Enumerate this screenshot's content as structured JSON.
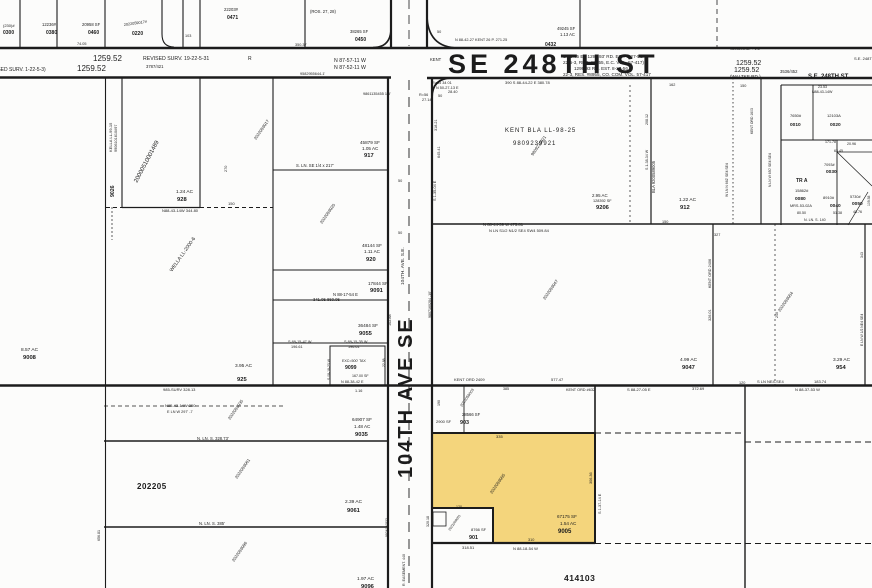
{
  "map": {
    "background": "#fcfcfb",
    "line_color": "#1c1c1c",
    "highlight_color": "#f4d57c",
    "streets": {
      "se_248th_main": "SE 248TH ST",
      "se_248th_right": "S.E. 248TH ST.",
      "waltke": "(WALTKE RD.)",
      "ave_104_main": "104TH AVE SE",
      "ave_104_small": "104TH. AVE. S.E."
    },
    "section_labels": [
      "202205",
      "414103"
    ],
    "highlighted_parcel": {
      "number": "9005",
      "sf": "67175 SF",
      "acres": "1.54 AC"
    }
  },
  "labels": [
    {
      "x": 3,
      "y": 27,
      "t": "(230)#",
      "s": 4
    },
    {
      "x": 3,
      "y": 34,
      "t": "0300",
      "s": 5,
      "b": 1
    },
    {
      "x": 42,
      "y": 26,
      "t": "12236#",
      "s": 4.2
    },
    {
      "x": 46,
      "y": 34,
      "t": "0380",
      "s": 5,
      "b": 1
    },
    {
      "x": 82,
      "y": 26,
      "t": "20958 SF",
      "s": 4.2
    },
    {
      "x": 88,
      "y": 34,
      "t": "0460",
      "s": 5,
      "b": 1
    },
    {
      "x": 77,
      "y": 45,
      "t": "74.05",
      "s": 3.8
    },
    {
      "x": 124,
      "y": 26,
      "t": "2022059017#",
      "s": 3.8,
      "r": -8
    },
    {
      "x": 132,
      "y": 35,
      "t": "0220",
      "s": 5,
      "b": 1
    },
    {
      "x": 185,
      "y": 37,
      "t": "103",
      "s": 3.8
    },
    {
      "x": 224,
      "y": 11,
      "t": "22203#",
      "s": 4.2
    },
    {
      "x": 227,
      "y": 19,
      "t": "0471",
      "s": 5,
      "b": 1
    },
    {
      "x": 310,
      "y": 13,
      "t": "(ROS. 27, 28)",
      "s": 4.2
    },
    {
      "x": 350,
      "y": 33,
      "t": "38265 SF",
      "s": 4.2
    },
    {
      "x": 355,
      "y": 41,
      "t": "0450",
      "s": 5,
      "b": 1
    },
    {
      "x": 295,
      "y": 46,
      "t": "350.37",
      "s": 3.8
    },
    {
      "x": 437,
      "y": 33,
      "t": "50",
      "s": 3.8
    },
    {
      "x": 455,
      "y": 41,
      "t": "N 88-42-27 KENT 26 P.  271.25",
      "s": 3.8
    },
    {
      "x": 557,
      "y": 30,
      "t": "49245 SF",
      "s": 4.2
    },
    {
      "x": 560,
      "y": 36,
      "t": "1.13 AC",
      "s": 4.2
    },
    {
      "x": 545,
      "y": 46,
      "t": "0432",
      "s": 5,
      "b": 1
    },
    {
      "x": 730,
      "y": 50,
      "t": "9803293487 - 1.5'",
      "s": 3.8
    },
    {
      "x": 93,
      "y": 61,
      "t": "1259.52",
      "s": 8
    },
    {
      "x": 143,
      "y": 60,
      "t": "REVISED SURV. 19-22-5-31",
      "s": 5.2
    },
    {
      "x": 248,
      "y": 60,
      "t": "R",
      "s": 5
    },
    {
      "x": 77,
      "y": 71,
      "t": "1259.52",
      "s": 8
    },
    {
      "x": -16,
      "y": 71,
      "t": "(REVISED SURV. 1-22-5-3)",
      "s": 5
    },
    {
      "x": 146,
      "y": 68,
      "t": "3787/421",
      "s": 4.2
    },
    {
      "x": 334,
      "y": 62,
      "t": "N 87-57-11 W",
      "s": 5.2
    },
    {
      "x": 334,
      "y": 69,
      "t": "N 87-52-11 W",
      "s": 5.2
    },
    {
      "x": 300,
      "y": 75,
      "t": "9582955644-1'",
      "s": 3.8
    },
    {
      "x": 430,
      "y": 61,
      "t": "KENT",
      "s": 4.2
    },
    {
      "x": 563,
      "y": 58,
      "t": "S 88-45 E - 1299.93' RD. EST. 8-27-56.",
      "s": 4.6
    },
    {
      "x": 563,
      "y": 64,
      "t": "22-5-3, RES. #8955, E.C. VOL. 57-417)",
      "s": 4.6
    },
    {
      "x": 736,
      "y": 65,
      "t": "1259.52",
      "s": 7
    },
    {
      "x": 574,
      "y": 70,
      "t": "1299.93 RD. EST. 8-27-56",
      "s": 4.6
    },
    {
      "x": 734,
      "y": 72,
      "t": "1259.52",
      "s": 7
    },
    {
      "x": 563,
      "y": 76,
      "t": "22-3, RES. #8955, CO. COM. VOL. 57-417",
      "s": 4.6
    },
    {
      "x": 780,
      "y": 73,
      "t": "3536/452",
      "s": 4.2
    },
    {
      "x": 854,
      "y": 60,
      "t": "S.E. 248TH ST.",
      "s": 4
    },
    {
      "x": 432,
      "y": 84,
      "t": "R=55 34 01",
      "s": 3.8
    },
    {
      "x": 436,
      "y": 89,
      "t": "N 50-27-13 E",
      "s": 3.8
    },
    {
      "x": 448,
      "y": 93,
      "t": "28.40",
      "s": 3.8
    },
    {
      "x": 419,
      "y": 96,
      "t": "R=56",
      "s": 3.8
    },
    {
      "x": 422,
      "y": 101,
      "t": "27.14",
      "s": 3.8
    },
    {
      "x": 363,
      "y": 95,
      "t": "9861135455 1.5'",
      "s": 3.8
    },
    {
      "x": 505,
      "y": 84,
      "t": "390    S 88-44-22 E    380.78",
      "s": 4
    },
    {
      "x": 112,
      "y": 152,
      "t": "KELLA LL-99-15",
      "s": 4,
      "r": -90
    },
    {
      "x": 117,
      "y": 152,
      "t": "9906101610#97",
      "s": 3.8,
      "r": -90
    },
    {
      "x": 114,
      "y": 197,
      "t": "9026",
      "s": 5.2,
      "b": 1,
      "r": -90
    },
    {
      "x": 176,
      "y": 193,
      "t": "1.24 AC",
      "s": 4.8
    },
    {
      "x": 177,
      "y": 201,
      "t": "928",
      "s": 5.8,
      "b": 1
    },
    {
      "x": 227,
      "y": 172,
      "t": "270",
      "s": 3.8,
      "r": -90
    },
    {
      "x": 137,
      "y": 183,
      "t": "20000510001489",
      "s": 6,
      "r": -62,
      "c": "#a8a8a8"
    },
    {
      "x": 256,
      "y": 140,
      "t": "2022059017",
      "s": 4.2,
      "r": -55,
      "c": "#b5b5b5"
    },
    {
      "x": 360,
      "y": 144,
      "t": "45879 SF",
      "s": 4.6
    },
    {
      "x": 362,
      "y": 150,
      "t": "1.05 AC",
      "s": 4.6
    },
    {
      "x": 364,
      "y": 157,
      "t": "917",
      "s": 5.8,
      "b": 1
    },
    {
      "x": 296,
      "y": 167,
      "t": "S. LN. SE 1/4 x 217'",
      "s": 4.2
    },
    {
      "x": 322,
      "y": 224,
      "t": "2022059020",
      "s": 4.2,
      "r": -55,
      "c": "#b5b5b5"
    },
    {
      "x": 362,
      "y": 247,
      "t": "48144 SF",
      "s": 4.6
    },
    {
      "x": 364,
      "y": 253,
      "t": "1.11 AC",
      "s": 4.6
    },
    {
      "x": 366,
      "y": 261,
      "t": "920",
      "s": 5.8,
      "b": 1
    },
    {
      "x": 368,
      "y": 285,
      "t": "17844 SF",
      "s": 4.6
    },
    {
      "x": 370,
      "y": 292,
      "t": "9091",
      "s": 5.8,
      "b": 1
    },
    {
      "x": 333,
      "y": 296,
      "t": "N 88-17-54 E",
      "s": 4.2
    },
    {
      "x": 313,
      "y": 301,
      "t": "341.05   860.05",
      "s": 4.2
    },
    {
      "x": 358,
      "y": 327,
      "t": "36484 SF",
      "s": 4.6
    },
    {
      "x": 391,
      "y": 326,
      "t": "102.88",
      "s": 3.8,
      "r": -90
    },
    {
      "x": 359,
      "y": 335,
      "t": "9055",
      "s": 5.8,
      "b": 1
    },
    {
      "x": 288,
      "y": 343,
      "t": "S 89-15-47 W",
      "s": 3.8
    },
    {
      "x": 291,
      "y": 348,
      "t": "196.61",
      "s": 3.8
    },
    {
      "x": 344,
      "y": 343,
      "t": "S 89-15-35 W",
      "s": 3.8
    },
    {
      "x": 348,
      "y": 348,
      "t": "196.61",
      "s": 3.8
    },
    {
      "x": 342,
      "y": 362,
      "t": "EXC=500' TAX",
      "s": 3.6
    },
    {
      "x": 345,
      "y": 369,
      "t": "9099",
      "s": 5.2,
      "b": 1
    },
    {
      "x": 352,
      "y": 377,
      "t": "167.00 SF",
      "s": 3.6
    },
    {
      "x": 341,
      "y": 383,
      "t": "N 88-38-42 E",
      "s": 3.8
    },
    {
      "x": 355,
      "y": 392,
      "t": "1.16",
      "s": 3.8
    },
    {
      "x": 330,
      "y": 380,
      "t": "S 08-18-23 W",
      "s": 3.4,
      "r": -90
    },
    {
      "x": 385,
      "y": 367,
      "t": "22.88",
      "s": 3.4,
      "r": -90
    },
    {
      "x": 235,
      "y": 367,
      "t": "3.95 AC",
      "s": 4.8
    },
    {
      "x": 237,
      "y": 381,
      "t": "925",
      "s": 5.8,
      "b": 1
    },
    {
      "x": 172,
      "y": 272,
      "t": "WELLA LL-2000-6",
      "s": 5,
      "r": -55
    },
    {
      "x": 162,
      "y": 212,
      "t": "N88-43-14W   344.80",
      "s": 4
    },
    {
      "x": 228,
      "y": 205,
      "t": "150",
      "s": 4
    },
    {
      "x": 21,
      "y": 351,
      "t": "8.57 AC",
      "s": 4.8
    },
    {
      "x": 23,
      "y": 359,
      "t": "9008",
      "s": 5.8,
      "b": 1
    },
    {
      "x": 163,
      "y": 391,
      "t": "985-SURV   328.13",
      "s": 4
    },
    {
      "x": 165,
      "y": 407,
      "t": "N85-43-14W    350",
      "s": 4
    },
    {
      "x": 167,
      "y": 413,
      "t": "E LN W 297' -7",
      "s": 3.8
    },
    {
      "x": 230,
      "y": 420,
      "t": "2022059035",
      "s": 4.2,
      "r": -55,
      "c": "#b5b5b5"
    },
    {
      "x": 352,
      "y": 421,
      "t": "64907 SF",
      "s": 4.6
    },
    {
      "x": 354,
      "y": 428,
      "t": "1.48 AC",
      "s": 4.6
    },
    {
      "x": 355,
      "y": 436,
      "t": "9035",
      "s": 5.8,
      "b": 1
    },
    {
      "x": 197,
      "y": 440,
      "t": "N. LN. S. 328.73'",
      "s": 4.2
    },
    {
      "x": 237,
      "y": 479,
      "t": "2022059061",
      "s": 4.2,
      "r": -55,
      "c": "#b5b5b5"
    },
    {
      "x": 345,
      "y": 503,
      "t": "2.39 AC",
      "s": 4.8
    },
    {
      "x": 347,
      "y": 512,
      "t": "9061",
      "s": 5.8,
      "b": 1
    },
    {
      "x": 199,
      "y": 525,
      "t": "N. LN. S. 385'",
      "s": 4.2
    },
    {
      "x": 234,
      "y": 562,
      "t": "2022059096",
      "s": 4.2,
      "r": -55,
      "c": "#b5b5b5"
    },
    {
      "x": 357,
      "y": 580,
      "t": "1.97 AC",
      "s": 4.8
    },
    {
      "x": 361,
      "y": 588,
      "t": "9096",
      "s": 5.8,
      "b": 1
    },
    {
      "x": 100,
      "y": 541,
      "t": "656.81",
      "s": 3.6,
      "r": -90
    },
    {
      "x": 388,
      "y": 537,
      "t": "9924190532",
      "s": 3.4,
      "r": -90,
      "c": "#9a9a9a"
    },
    {
      "x": 398,
      "y": 182,
      "t": "50",
      "s": 3.8
    },
    {
      "x": 398,
      "y": 234,
      "t": "50",
      "s": 3.8
    },
    {
      "x": 438,
      "y": 97,
      "t": "50",
      "s": 3.8
    },
    {
      "x": 431,
      "y": 318,
      "t": "9807160284 -10'",
      "s": 3.6,
      "r": -90
    },
    {
      "x": 429,
      "y": 527,
      "t": "320.18",
      "s": 3.6,
      "r": -90
    },
    {
      "x": 405,
      "y": 586,
      "t": "R. EASEMENT. 440",
      "s": 3.6,
      "r": -90,
      "c": "#8a8a8a"
    },
    {
      "x": 505,
      "y": 132,
      "t": "KENT BLA LL-98-25",
      "s": 6,
      "ls": 1
    },
    {
      "x": 513,
      "y": 145,
      "t": "9809239921",
      "s": 6,
      "ls": 1
    },
    {
      "x": 533,
      "y": 156,
      "t": "9809239921",
      "s": 4.2,
      "r": -55,
      "c": "#b5b5b5"
    },
    {
      "x": 592,
      "y": 197,
      "t": "2.95 AC",
      "s": 4.4
    },
    {
      "x": 593,
      "y": 202,
      "t": "128392 SF",
      "s": 3.8
    },
    {
      "x": 596,
      "y": 209,
      "t": "9206",
      "s": 5.8,
      "b": 1
    },
    {
      "x": 440,
      "y": 158,
      "t": "645.41",
      "s": 3.8,
      "r": -90
    },
    {
      "x": 437,
      "y": 131,
      "t": "318.21",
      "s": 3.8,
      "r": -90
    },
    {
      "x": 436,
      "y": 201,
      "t": "S 1-35-04 E",
      "s": 3.8,
      "r": -90
    },
    {
      "x": 648,
      "y": 170,
      "t": "S 1-38-34 W",
      "s": 3.6,
      "r": -90
    },
    {
      "x": 648,
      "y": 125,
      "t": "208.12",
      "s": 3.6,
      "r": -90
    },
    {
      "x": 483,
      "y": 226,
      "t": "N 88-44-39 W    475.81",
      "s": 4.2
    },
    {
      "x": 489,
      "y": 232,
      "t": "N LN S1/2 N1/2 SE4 SW4    509.84",
      "s": 4
    },
    {
      "x": 662,
      "y": 223,
      "t": "150",
      "s": 3.8
    },
    {
      "x": 714,
      "y": 236,
      "t": "327",
      "s": 3.8
    },
    {
      "x": 679,
      "y": 201,
      "t": "1.22 AC",
      "s": 4.8
    },
    {
      "x": 680,
      "y": 209,
      "t": "912",
      "s": 5.8,
      "b": 1
    },
    {
      "x": 655,
      "y": 193,
      "t": "BLA 9200589005",
      "s": 4.2,
      "r": -90
    },
    {
      "x": 669,
      "y": 86,
      "t": "162",
      "s": 3.8
    },
    {
      "x": 740,
      "y": 87,
      "t": "150",
      "s": 3.8
    },
    {
      "x": 728,
      "y": 197,
      "t": "W LN N 662' SE4 SE4",
      "s": 3.4,
      "r": -90
    },
    {
      "x": 753,
      "y": 134,
      "t": "KENT ORD 1603",
      "s": 3.4,
      "r": -90
    },
    {
      "x": 771,
      "y": 187,
      "t": "N LN W 650' SE4 SE4",
      "s": 3.4,
      "r": -90
    },
    {
      "x": 818,
      "y": 88,
      "t": "23.53",
      "s": 3.6
    },
    {
      "x": 812,
      "y": 93,
      "t": "N88-43-14W",
      "s": 3.6
    },
    {
      "x": 790,
      "y": 117,
      "t": "7650#",
      "s": 4
    },
    {
      "x": 790,
      "y": 126,
      "t": "0010",
      "s": 4.8,
      "b": 1
    },
    {
      "x": 827,
      "y": 117,
      "t": "12103A",
      "s": 4
    },
    {
      "x": 830,
      "y": 126,
      "t": "0020",
      "s": 4.8,
      "b": 1
    },
    {
      "x": 825,
      "y": 143,
      "t": "171.78",
      "s": 3.6
    },
    {
      "x": 847,
      "y": 145,
      "t": "20.96",
      "s": 3.6
    },
    {
      "x": 834,
      "y": 152,
      "t": "63.45",
      "s": 3.6
    },
    {
      "x": 796,
      "y": 182,
      "t": "TR A",
      "s": 5,
      "b": 1
    },
    {
      "x": 795,
      "y": 192,
      "t": "15862#",
      "s": 4
    },
    {
      "x": 795,
      "y": 200,
      "t": "0080",
      "s": 4.8,
      "b": 1
    },
    {
      "x": 790,
      "y": 207,
      "t": "MRS-53-02A",
      "s": 3.8
    },
    {
      "x": 797,
      "y": 214,
      "t": "80.50",
      "s": 3.6
    },
    {
      "x": 804,
      "y": 221,
      "t": "N. LN. S. 140",
      "s": 3.6
    },
    {
      "x": 824,
      "y": 166,
      "t": "7093#",
      "s": 3.8
    },
    {
      "x": 826,
      "y": 173,
      "t": "0030",
      "s": 4.8,
      "b": 1
    },
    {
      "x": 823,
      "y": 199,
      "t": "8910#",
      "s": 4
    },
    {
      "x": 830,
      "y": 207,
      "t": "0040",
      "s": 4.8,
      "b": 1
    },
    {
      "x": 833,
      "y": 214,
      "t": "51.38",
      "s": 3.6
    },
    {
      "x": 850,
      "y": 198,
      "t": "5730#",
      "s": 3.8
    },
    {
      "x": 852,
      "y": 205,
      "t": "0050",
      "s": 4.8,
      "b": 1
    },
    {
      "x": 853,
      "y": 213,
      "t": "48.76",
      "s": 3.6
    },
    {
      "x": 870,
      "y": 206,
      "t": "109.58",
      "s": 3.4,
      "r": -90
    },
    {
      "x": 545,
      "y": 300,
      "t": "2022059047",
      "s": 4.2,
      "r": -55,
      "c": "#b5b5b5"
    },
    {
      "x": 680,
      "y": 361,
      "t": "4.99 AC",
      "s": 4.8
    },
    {
      "x": 682,
      "y": 369,
      "t": "9047",
      "s": 5.8,
      "b": 1
    },
    {
      "x": 711,
      "y": 288,
      "t": "KENT ORD 2406",
      "s": 3.8,
      "r": -90
    },
    {
      "x": 711,
      "y": 321,
      "t": "326.01",
      "s": 3.8,
      "r": -90
    },
    {
      "x": 780,
      "y": 312,
      "t": "2022059054",
      "s": 4.2,
      "r": -55,
      "c": "#b5b5b5"
    },
    {
      "x": 833,
      "y": 361,
      "t": "3.29 AC",
      "s": 4.8
    },
    {
      "x": 836,
      "y": 369,
      "t": "954",
      "s": 5.8,
      "b": 1
    },
    {
      "x": 863,
      "y": 346,
      "t": "E LN W 1/2 NE4 SE4",
      "s": 3.4,
      "r": -90
    },
    {
      "x": 863,
      "y": 258,
      "t": "343",
      "s": 3.6,
      "r": -90
    },
    {
      "x": 778,
      "y": 318,
      "t": "240",
      "s": 3.6,
      "r": -90
    },
    {
      "x": 627,
      "y": 391,
      "t": "S 88-27-05 E",
      "s": 4
    },
    {
      "x": 692,
      "y": 390,
      "t": "372.69",
      "s": 4
    },
    {
      "x": 739,
      "y": 384,
      "t": "120",
      "s": 3.8
    },
    {
      "x": 757,
      "y": 383,
      "t": "S LN NE4-SE4",
      "s": 4
    },
    {
      "x": 814,
      "y": 383,
      "t": "183.74",
      "s": 4
    },
    {
      "x": 795,
      "y": 391,
      "t": "N 88-37-53 W",
      "s": 4
    },
    {
      "x": 454,
      "y": 381,
      "t": "KENT ORD 2409",
      "s": 4
    },
    {
      "x": 551,
      "y": 381,
      "t": "577.47",
      "s": 4
    },
    {
      "x": 503,
      "y": 390,
      "t": "385",
      "s": 3.6
    },
    {
      "x": 566,
      "y": 391,
      "t": "KENT ORD #632",
      "s": 3.8
    },
    {
      "x": 436,
      "y": 423,
      "t": "2900 SF",
      "s": 4
    },
    {
      "x": 440,
      "y": 406,
      "t": "190",
      "s": 3.6,
      "r": -90
    },
    {
      "x": 462,
      "y": 416,
      "t": "28566 SF",
      "s": 4.2
    },
    {
      "x": 460,
      "y": 424,
      "t": "903",
      "s": 5.4,
      "b": 1
    },
    {
      "x": 462,
      "y": 407,
      "t": "2022059003",
      "s": 3.8,
      "r": -55,
      "c": "#b5b5b5"
    },
    {
      "x": 496,
      "y": 438,
      "t": "335",
      "s": 4
    },
    {
      "x": 592,
      "y": 484,
      "t": "306.36",
      "s": 3.8,
      "r": -90
    },
    {
      "x": 601,
      "y": 514,
      "t": "S 1-37-14 E",
      "s": 3.8,
      "r": -90
    },
    {
      "x": 492,
      "y": 494,
      "t": "2022059005",
      "s": 4.2,
      "r": -55,
      "c": "#c3a24e"
    },
    {
      "x": 456,
      "y": 508,
      "t": "120",
      "s": 3.6
    },
    {
      "x": 450,
      "y": 531,
      "t": "2022059001",
      "s": 3.4,
      "r": -55,
      "c": "#b5b5b5"
    },
    {
      "x": 471,
      "y": 531,
      "t": "8766 SF",
      "s": 4
    },
    {
      "x": 469,
      "y": 539,
      "t": "901",
      "s": 5.4,
      "b": 1
    },
    {
      "x": 528,
      "y": 541,
      "t": "310",
      "s": 3.8
    },
    {
      "x": 462,
      "y": 549,
      "t": "318.51",
      "s": 4
    },
    {
      "x": 513,
      "y": 550,
      "t": "N 88-18-54 W",
      "s": 4
    }
  ]
}
